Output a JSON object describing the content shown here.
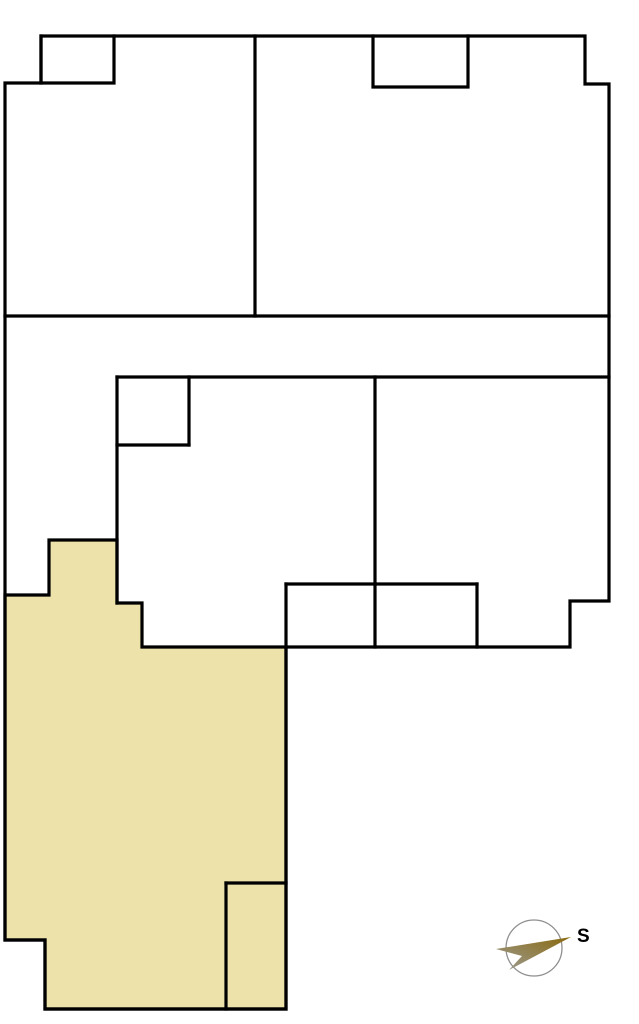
{
  "canvas": {
    "width": 639,
    "height": 1024,
    "background": "#FFFFFF"
  },
  "plan": {
    "wall_color": "#000000",
    "wall_width": 3.2,
    "outline": "5,83 41,83 41,36 585,36 585,84 609,84 609,601 570,601 570,647 286,647 286,1009 45,1009 45,940 5,940",
    "highlighted_room": {
      "fill": "#EDE2AA",
      "stroke": "#000000",
      "points": "5,595 49,595 49,540 117,540 117,603 142,603 142,647 286,647 286,1009 45,1009 45,940 5,940"
    },
    "inner_walls": [
      {
        "name": "top-left-closet",
        "points": "41,36 41,83 114,83 114,36"
      },
      {
        "name": "top-right-closet",
        "points": "373,36 373,87 468,87 468,36"
      },
      {
        "name": "upper-band-divider",
        "points": "5,316 609,316"
      },
      {
        "name": "top-rooms-divider",
        "points": "255,36 255,316"
      },
      {
        "name": "middle-rooms-top",
        "points": "117,377 609,377"
      },
      {
        "name": "middle-left-wall",
        "points": "117,377 117,603"
      },
      {
        "name": "middle-shaft-right",
        "points": "189,377 189,445"
      },
      {
        "name": "middle-shaft-bottom",
        "points": "117,445 189,445"
      },
      {
        "name": "middle-rooms-divider",
        "points": "375,377 375,647"
      },
      {
        "name": "closet-row-top",
        "points": "286,584 477,584"
      },
      {
        "name": "closet-row-left",
        "points": "286,584 286,647"
      },
      {
        "name": "closet-row-right",
        "points": "477,584 477,647"
      },
      {
        "name": "subroom-left-wall",
        "points": "226,883 226,1009"
      },
      {
        "name": "subroom-top-wall",
        "points": "226,883 286,883"
      }
    ]
  },
  "compass": {
    "label": "S",
    "circle": {
      "cx": 534,
      "cy": 948,
      "r": 28,
      "stroke": "#8F8F8F",
      "stroke_width": 1.3
    },
    "needle": {
      "points": "571,937 496,949 522,956 509,970",
      "color_start": "#9C9C95",
      "color_end": "#8A6A0E"
    },
    "label_x": 577,
    "label_y": 942,
    "label_size": 19,
    "label_color": "#000000"
  }
}
